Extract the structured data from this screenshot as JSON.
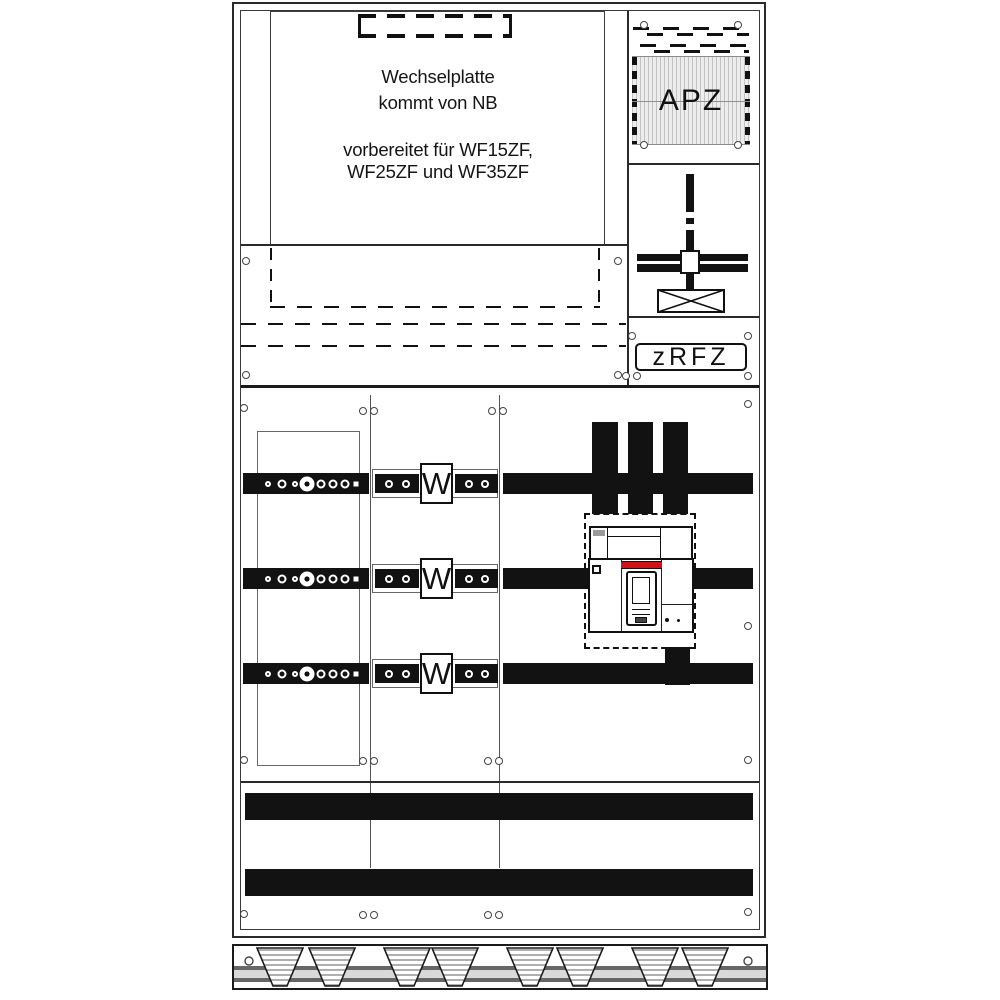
{
  "panel": {
    "note": {
      "line1": "Wechselplatte",
      "line2": "kommt von NB",
      "line3": "vorbereitet für WF15ZF,",
      "line4": "WF25ZF und WF35ZF"
    },
    "right_column": {
      "apz_label": "APZ",
      "zrfz_label": "zRFZ"
    },
    "meters": [
      {
        "label": "W"
      },
      {
        "label": "W"
      },
      {
        "label": "W"
      }
    ],
    "colors": {
      "line_color": "#1a1a1a",
      "busbar_color": "#121212",
      "breaker_accent_red": "#d01217",
      "hatch_background": "#ededed"
    }
  }
}
